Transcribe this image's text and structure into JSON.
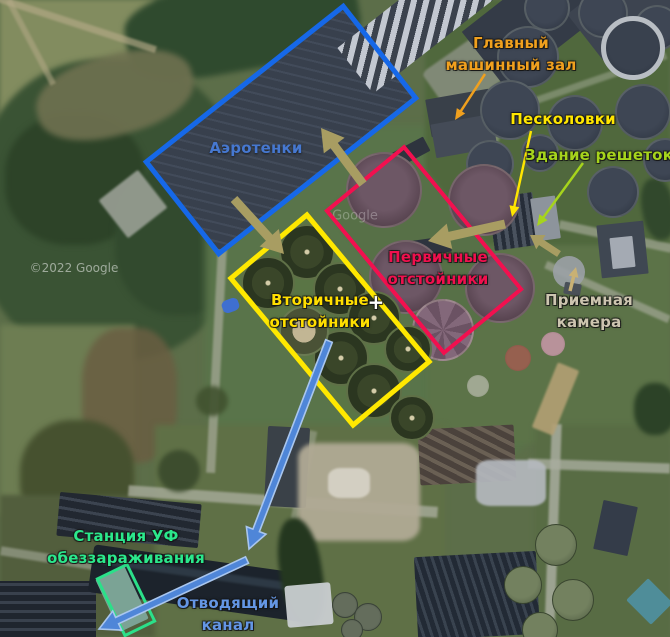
{
  "map": {
    "kind": "annotated-satellite-view",
    "labels": [
      {
        "id": "glavny-mashinny-zal",
        "lines": [
          "Главный",
          "машинный зал"
        ],
        "color": "#f0a01e",
        "cx": 511,
        "cy": 54
      },
      {
        "id": "peskolovki",
        "lines": [
          "Песколовки"
        ],
        "color": "#ffe600",
        "cx": 563,
        "cy": 119
      },
      {
        "id": "zdanie-reshetok",
        "lines": [
          "Здание решеток"
        ],
        "color": "#a6d41c",
        "cx": 599,
        "cy": 155
      },
      {
        "id": "aerotenki",
        "lines": [
          "Аэротенки"
        ],
        "color": "#4678d0",
        "cx": 256,
        "cy": 148,
        "outline": "soft"
      },
      {
        "id": "pervichnye-otstoyniki",
        "lines": [
          "Первичные",
          "отстойники"
        ],
        "color": "#f0104e",
        "cx": 438,
        "cy": 268
      },
      {
        "id": "vtorichnye-otstoyniki",
        "lines": [
          "Вторичные",
          "отстойники"
        ],
        "color": "#ffdf00",
        "cx": 320,
        "cy": 311
      },
      {
        "id": "plus-marker",
        "lines": [
          "+"
        ],
        "color": "#ffffff",
        "cx": 376,
        "cy": 302,
        "size": 20
      },
      {
        "id": "priemnaya-kamera",
        "lines": [
          "Приемная",
          "камера"
        ],
        "color": "#cdc5b0",
        "cx": 589,
        "cy": 311
      },
      {
        "id": "uv-station",
        "lines": [
          "Станция УФ",
          "обеззараживания"
        ],
        "color": "#2be88c",
        "cx": 126,
        "cy": 547
      },
      {
        "id": "otvodyashchiy-kanal",
        "lines": [
          "Отводящий",
          "канал"
        ],
        "color": "#6496e4",
        "cx": 228,
        "cy": 614
      }
    ],
    "boxes": [
      {
        "id": "aeration-box",
        "color": "#1668e8",
        "cx": 281,
        "cy": 130,
        "w": 256,
        "h": 122,
        "rot": -38.3,
        "stroke": 5
      },
      {
        "id": "secondary-box",
        "color": "#ffe800",
        "cx": 330,
        "cy": 320,
        "w": 196,
        "h": 104,
        "rot": 50.2,
        "stroke": 5
      },
      {
        "id": "primary-box",
        "color": "#f2104f",
        "cx": 424,
        "cy": 250,
        "w": 188,
        "h": 104,
        "rot": 50.5,
        "stroke": 4
      },
      {
        "id": "uv-box",
        "color": "#2be089",
        "cx": 126,
        "cy": 600,
        "w": 36,
        "h": 66,
        "rot": -26,
        "stroke": 3
      }
    ],
    "arrows": [
      {
        "id": "arrow-glavny",
        "from": [
          485,
          74
        ],
        "to": [
          455,
          120
        ],
        "color": "#f0a01e",
        "style": "thin"
      },
      {
        "id": "arrow-peskolovki",
        "from": [
          531,
          131
        ],
        "to": [
          512,
          217
        ],
        "color": "#ffe600",
        "style": "thin"
      },
      {
        "id": "arrow-reshetki",
        "from": [
          583,
          163
        ],
        "to": [
          537,
          226
        ],
        "color": "#a6d41c",
        "style": "thin"
      },
      {
        "id": "arrow-priemnaya",
        "from": [
          570,
          291
        ],
        "to": [
          576,
          267
        ],
        "color": "#c9b174",
        "style": "med"
      },
      {
        "id": "arrow-flow-aeration",
        "from": [
          363,
          184
        ],
        "to": [
          321,
          128
        ],
        "color": "#a89d62",
        "style": "thick"
      },
      {
        "id": "arrow-flow-secondary",
        "from": [
          234,
          199
        ],
        "to": [
          284,
          254
        ],
        "color": "#a89d62",
        "style": "thick"
      },
      {
        "id": "arrow-flow-primary",
        "from": [
          505,
          224
        ],
        "to": [
          428,
          241
        ],
        "color": "#a89d62",
        "style": "thick"
      },
      {
        "id": "arrow-flow-reshetki",
        "from": [
          559,
          254
        ],
        "to": [
          530,
          235
        ],
        "color": "#a89d62",
        "style": "thick-small"
      },
      {
        "id": "arrow-flow-canal-1",
        "from": [
          329,
          341
        ],
        "to": [
          249,
          549
        ],
        "color": "#4f86d8",
        "style": "blue"
      },
      {
        "id": "arrow-flow-canal-2",
        "from": [
          247,
          560
        ],
        "to": [
          99,
          629
        ],
        "color": "#4f86d8",
        "style": "blue"
      }
    ],
    "watermarks": [
      {
        "id": "copyright-watermark",
        "text": "©2022 Google",
        "cx": 74,
        "cy": 268,
        "size": 12,
        "opacity": 0.5
      },
      {
        "id": "google-watermark",
        "text": "Google",
        "cx": 355,
        "cy": 216,
        "size": 13,
        "opacity": 0.28
      }
    ]
  }
}
